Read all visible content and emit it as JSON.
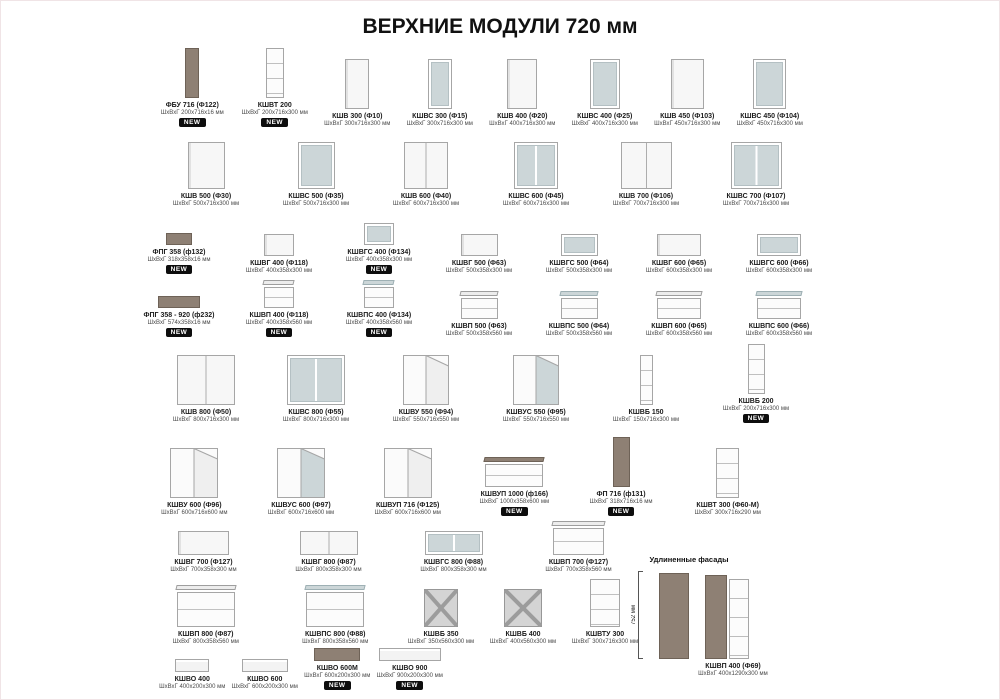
{
  "page": {
    "title": "ВЕРХНИЕ МОДУЛИ 720 мм"
  },
  "badges": {
    "new_label": "NEW"
  },
  "colors": {
    "taupe": "#8e8074",
    "glass": "#ccd6d8",
    "badge": "#0d0d0d"
  },
  "extended_section": {
    "heading": "Удлиненные фасады",
    "vertical_dim": "752 мм",
    "item": {
      "name": "КШВП 400 (Ф69)",
      "dims": "ШхВхГ 400х1290х300 мм"
    }
  },
  "rows": [
    {
      "items": [
        {
          "name": "ФБУ 716 (Ф122)",
          "dims": "ШхВхГ 200х716х16 мм",
          "new": true,
          "glyph": {
            "type": "panel",
            "w": 14,
            "h": 50
          }
        },
        {
          "name": "КШВТ 200",
          "dims": "ШхВхГ 200х716х300 мм",
          "new": true,
          "glyph": {
            "type": "open",
            "w": 18,
            "h": 50
          }
        },
        {
          "name": "КШВ 300 (Ф10)",
          "dims": "ШхВхГ 300х716х300 мм",
          "glyph": {
            "type": "door",
            "w": 24,
            "h": 50
          }
        },
        {
          "name": "КШВС 300 (Ф15)",
          "dims": "ШхВхГ 300х716х300 мм",
          "glyph": {
            "type": "glass",
            "w": 24,
            "h": 50
          }
        },
        {
          "name": "КШВ 400 (Ф20)",
          "dims": "ШхВхГ 400х716х300 мм",
          "glyph": {
            "type": "door",
            "w": 30,
            "h": 50
          }
        },
        {
          "name": "КШВС 400 (Ф25)",
          "dims": "ШхВхГ 400х716х300 мм",
          "glyph": {
            "type": "glass",
            "w": 30,
            "h": 50
          }
        },
        {
          "name": "КШВ 450 (Ф103)",
          "dims": "ШхВхГ 450х716х300 мм",
          "glyph": {
            "type": "door",
            "w": 33,
            "h": 50
          }
        },
        {
          "name": "КШВС 450 (Ф104)",
          "dims": "ШхВхГ 450х716х300 мм",
          "glyph": {
            "type": "glass",
            "w": 33,
            "h": 50
          }
        }
      ]
    },
    {
      "items": [
        {
          "name": "КШВ 500 (Ф30)",
          "dims": "ШхВхГ 500х716х300 мм",
          "glyph": {
            "type": "door",
            "w": 37,
            "h": 47
          }
        },
        {
          "name": "КШВС 500 (Ф35)",
          "dims": "ШхВхГ 500х716х300 мм",
          "glyph": {
            "type": "glass",
            "w": 37,
            "h": 47
          }
        },
        {
          "name": "КШВ 600 (Ф40)",
          "dims": "ШхВхГ 600х716х300 мм",
          "glyph": {
            "type": "door2",
            "w": 44,
            "h": 47
          }
        },
        {
          "name": "КШВС 600 (Ф45)",
          "dims": "ШхВхГ 600х716х300 мм",
          "glyph": {
            "type": "glass2",
            "w": 44,
            "h": 47
          }
        },
        {
          "name": "КШВ 700 (Ф106)",
          "dims": "ШхВхГ 700х716х300 мм",
          "glyph": {
            "type": "door2",
            "w": 51,
            "h": 47
          }
        },
        {
          "name": "КШВС 700 (Ф107)",
          "dims": "ШхВхГ 700х716х300 мм",
          "glyph": {
            "type": "glass2",
            "w": 51,
            "h": 47
          }
        }
      ]
    },
    {
      "items": [
        {
          "name": "ФПГ 358 (ф132)",
          "dims": "ШхВхГ 318х358х16 мм",
          "new": true,
          "glyph": {
            "type": "panel",
            "w": 26,
            "h": 12
          }
        },
        {
          "name": "КШВГ 400 (Ф118)",
          "dims": "ШхВхГ 400х358х300 мм",
          "glyph": {
            "type": "door",
            "w": 30,
            "h": 22
          }
        },
        {
          "name": "КШВГС 400 (Ф134)",
          "dims": "ШхВхГ 400х358х300 мм",
          "new": true,
          "glyph": {
            "type": "glass",
            "w": 30,
            "h": 22
          }
        },
        {
          "name": "КШВГ 500 (Ф63)",
          "dims": "ШхВхГ 500х358х300 мм",
          "glyph": {
            "type": "door",
            "w": 37,
            "h": 22
          }
        },
        {
          "name": "КШВГС 500 (Ф64)",
          "dims": "ШхВхГ 500х358х300 мм",
          "glyph": {
            "type": "glass",
            "w": 37,
            "h": 22
          }
        },
        {
          "name": "КШВГ 600 (Ф65)",
          "dims": "ШхВхГ 600х358х300 мм",
          "glyph": {
            "type": "door",
            "w": 44,
            "h": 22
          }
        },
        {
          "name": "КШВГС 600 (Ф66)",
          "dims": "ШхВхГ 600х358х300 мм",
          "glyph": {
            "type": "glass",
            "w": 44,
            "h": 22
          }
        }
      ]
    },
    {
      "items": [
        {
          "name": "ФПГ 358 - 920 (ф232)",
          "dims": "ШхВхГ 574х358х16 мм",
          "new": true,
          "glyph": {
            "type": "panel",
            "w": 42,
            "h": 12
          }
        },
        {
          "name": "КШВП 400 (Ф118)",
          "dims": "ШхВхГ 400х358х560 мм",
          "new": true,
          "glyph": {
            "type": "flip",
            "w": 30,
            "h": 28
          }
        },
        {
          "name": "КШВПС 400 (Ф134)",
          "dims": "ШхВхГ 400х358х560 мм",
          "new": true,
          "glyph": {
            "type": "flipg",
            "w": 30,
            "h": 28
          }
        },
        {
          "name": "КШВП 500 (Ф63)",
          "dims": "ШхВхГ 500х358х560 мм",
          "glyph": {
            "type": "flip",
            "w": 37,
            "h": 28
          }
        },
        {
          "name": "КШВПС 500 (Ф64)",
          "dims": "ШхВхГ 500х358х560 мм",
          "glyph": {
            "type": "flipg",
            "w": 37,
            "h": 28
          }
        },
        {
          "name": "КШВП 600 (Ф65)",
          "dims": "ШхВхГ 600х358х560 мм",
          "glyph": {
            "type": "flip",
            "w": 44,
            "h": 28
          }
        },
        {
          "name": "КШВПС 600 (Ф66)",
          "dims": "ШхВхГ 600х358х560 мм",
          "glyph": {
            "type": "flipg",
            "w": 44,
            "h": 28
          }
        }
      ]
    },
    {
      "items": [
        {
          "name": "КШВ 800 (Ф50)",
          "dims": "ШхВхГ 800х716х300 мм",
          "glyph": {
            "type": "door2",
            "w": 58,
            "h": 50
          }
        },
        {
          "name": "КШВС 800 (Ф55)",
          "dims": "ШхВхГ 800х716х300 мм",
          "glyph": {
            "type": "glass2",
            "w": 58,
            "h": 50
          }
        },
        {
          "name": "КШВУ 550 (Ф94)",
          "dims": "ШхВхГ 550х716х550 мм",
          "glyph": {
            "type": "corner",
            "w": 46,
            "h": 50
          }
        },
        {
          "name": "КШВУС 550 (Ф95)",
          "dims": "ШхВхГ 550х716х550 мм",
          "glyph": {
            "type": "cornerg",
            "w": 46,
            "h": 50
          }
        },
        {
          "name": "КШВБ 150",
          "dims": "ШхВхГ 150х716х300 мм",
          "glyph": {
            "type": "open",
            "w": 13,
            "h": 50
          }
        },
        {
          "name": "КШВБ 200",
          "dims": "ШхВхГ 200х716х300 мм",
          "new": true,
          "glyph": {
            "type": "open",
            "w": 17,
            "h": 50
          }
        }
      ]
    },
    {
      "items": [
        {
          "name": "КШВУ 600 (Ф96)",
          "dims": "ШхВхГ 600х716х600 мм",
          "glyph": {
            "type": "corner",
            "w": 48,
            "h": 50
          }
        },
        {
          "name": "КШВУС 600 (Ф97)",
          "dims": "ШхВхГ 600х716х600 мм",
          "glyph": {
            "type": "cornerg",
            "w": 48,
            "h": 50
          }
        },
        {
          "name": "КШВУП 716 (Ф125)",
          "dims": "ШхВхГ 600х716х600 мм",
          "glyph": {
            "type": "corner",
            "w": 48,
            "h": 50
          }
        },
        {
          "name": "КШВУП 1000 (ф166)",
          "dims": "ШхВхГ 1000х358х600 мм",
          "new": true,
          "glyph": {
            "type": "flipd",
            "w": 58,
            "h": 30
          }
        },
        {
          "name": "ФП 716 (ф131)",
          "dims": "ШхВхГ 318х716х16 мм",
          "new": true,
          "glyph": {
            "type": "panel",
            "w": 17,
            "h": 50
          }
        },
        {
          "name": "КШВТ 300 (Ф60-М)",
          "dims": "ШхВхГ 300х716х290 мм",
          "glyph": {
            "type": "open",
            "w": 23,
            "h": 50
          }
        }
      ]
    },
    {
      "items": [
        {
          "name": "КШВГ 700 (Ф127)",
          "dims": "ШхВхГ 700х358х300 мм",
          "glyph": {
            "type": "door",
            "w": 51,
            "h": 24
          }
        },
        {
          "name": "КШВГ 800 (Ф87)",
          "dims": "ШхВхГ 800х358х300 мм",
          "glyph": {
            "type": "door2",
            "w": 58,
            "h": 24
          }
        },
        {
          "name": "КШВГС 800 (Ф88)",
          "dims": "ШхВхГ 800х358х300 мм",
          "glyph": {
            "type": "glass2",
            "w": 58,
            "h": 24
          }
        },
        {
          "name": "КШВП 700 (Ф127)",
          "dims": "ШхВхГ 700х358х560 мм",
          "glyph": {
            "type": "flip",
            "w": 51,
            "h": 34
          }
        }
      ]
    },
    {
      "items": [
        {
          "name": "КШВП 800 (Ф87)",
          "dims": "ШхВхГ 800х358х560 мм",
          "glyph": {
            "type": "flip",
            "w": 58,
            "h": 42
          }
        },
        {
          "name": "КШВПС 800 (Ф88)",
          "dims": "ШхВхГ 800х358х560 мм",
          "glyph": {
            "type": "flipg",
            "w": 58,
            "h": 42
          }
        },
        {
          "name": "КШВБ 350",
          "dims": "ШхВхГ 350х560х300 мм",
          "glyph": {
            "type": "wine",
            "w": 34,
            "h": 38
          }
        },
        {
          "name": "КШВБ 400",
          "dims": "ШхВхГ 400х560х300 мм",
          "glyph": {
            "type": "wine",
            "w": 38,
            "h": 38
          }
        },
        {
          "name": "КШВТУ 300",
          "dims": "ШхВхГ 300х716х300 мм",
          "glyph": {
            "type": "open",
            "w": 30,
            "h": 48
          }
        }
      ]
    },
    {
      "items": [
        {
          "name": "КШВО 400",
          "dims": "ШхВхГ 400х200х300 мм",
          "glyph": {
            "type": "shelf",
            "w": 34,
            "h": 13
          }
        },
        {
          "name": "КШВО 600",
          "dims": "ШхВхГ 600х200х300 мм",
          "glyph": {
            "type": "shelf",
            "w": 46,
            "h": 13
          }
        },
        {
          "name": "КШВО 600М",
          "dims": "ШхВхГ 600х200х300 мм",
          "new": true,
          "glyph": {
            "type": "shelfd",
            "w": 46,
            "h": 13
          }
        },
        {
          "name": "КШВО 900",
          "dims": "ШхВхГ 900х200х300 мм",
          "new": true,
          "glyph": {
            "type": "shelf",
            "w": 62,
            "h": 13
          }
        }
      ]
    }
  ]
}
